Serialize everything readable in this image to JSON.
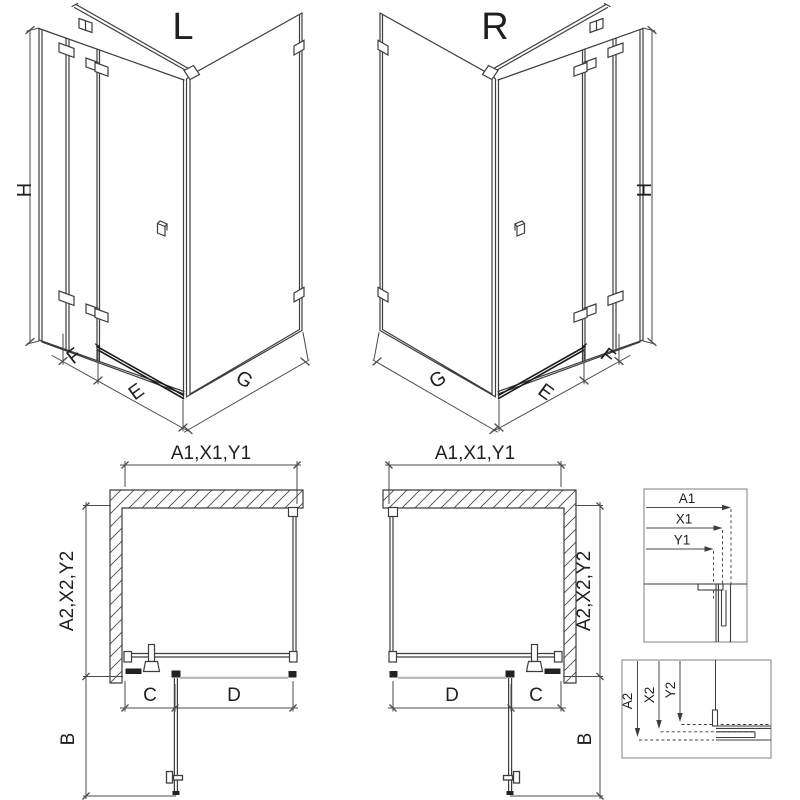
{
  "drawing": {
    "background": "#ffffff",
    "line_color": "#3d3d3d",
    "dim_color": "#4a4a4a",
    "dark_fitting_color": "#222222",
    "tray_color": "#b5b5b5",
    "views": {
      "iso_left": {
        "label": "L",
        "dim_height": "H",
        "dim_fixed": "F",
        "dim_door": "E",
        "dim_side": "G"
      },
      "iso_right": {
        "label": "R",
        "dim_height": "H",
        "dim_fixed": "F",
        "dim_door": "E",
        "dim_side": "G"
      },
      "plan_left": {
        "dim_width": "A1,X1,Y1",
        "dim_depth": "A2,X2,Y2",
        "dim_c": "C",
        "dim_d": "D",
        "dim_b": "B"
      },
      "plan_right": {
        "dim_width": "A1,X1,Y1",
        "dim_depth": "A2,X2,Y2",
        "dim_c": "C",
        "dim_d": "D",
        "dim_b": "B"
      },
      "detail_width": {
        "dims": [
          "A1",
          "X1",
          "Y1"
        ]
      },
      "detail_depth": {
        "dims": [
          "A2",
          "X2",
          "Y2"
        ]
      }
    }
  }
}
